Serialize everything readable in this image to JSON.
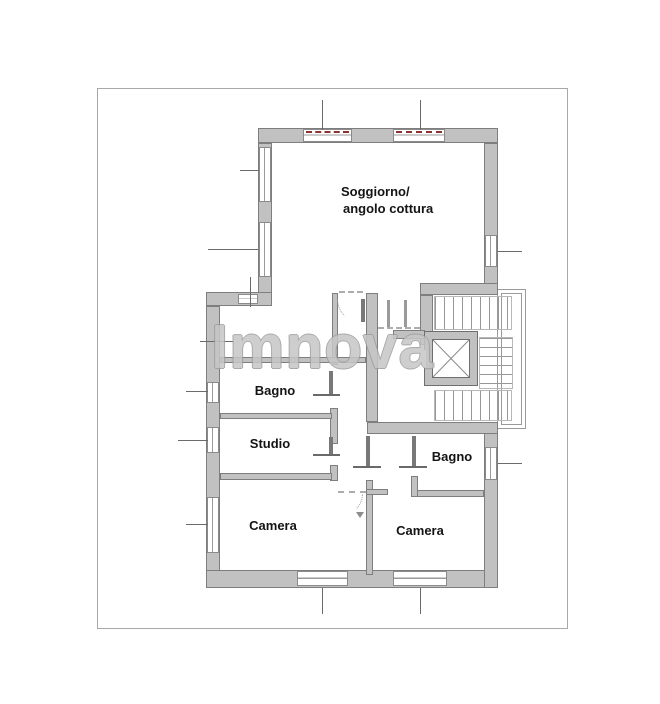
{
  "document": {
    "type": "floor-plan",
    "sheet_border_color": "#a8a8a8",
    "background_color": "#ffffff"
  },
  "watermark": {
    "text": "Imnova",
    "color": "#c6c6c6"
  },
  "rooms": {
    "soggiorno_line1": "Soggiorno/",
    "soggiorno_line2": "angolo cottura",
    "bagno_left": "Bagno",
    "studio": "Studio",
    "camera_left": "Camera",
    "bagno_right": "Bagno",
    "camera_right": "Camera"
  },
  "features": [
    "exterior-walls",
    "interior-partitions",
    "windows-with-red-markers",
    "door-swings",
    "staircase",
    "elevator-shaft-x",
    "dimension-ticks"
  ],
  "colors": {
    "wall_fill": "#c1c1c1",
    "wall_edge": "#7e7e7e",
    "window_red_marker": "#8b3333",
    "label_text": "#141414"
  }
}
